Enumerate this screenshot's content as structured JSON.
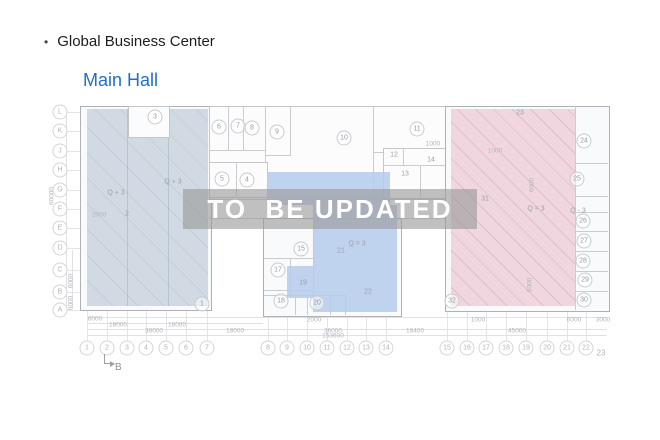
{
  "slide": {
    "bullet": "•",
    "title": "Global Business Center",
    "subtitle": "Main Hall",
    "watermark": "TO  BE UPDATED"
  },
  "colors": {
    "subtitle_blue": "#1d6ed0",
    "zone_left": "rgba(203,213,223,0.88)",
    "zone_left_hatch": "rgba(125,145,168,0.16)",
    "zone_middle": "rgba(181,203,235,0.85)",
    "zone_right": "rgba(238,211,220,0.9)",
    "zone_right_hatch": "rgba(196,144,162,0.35)",
    "watermark_band": "rgba(154,154,154,0.62)",
    "watermark_text": "#ffffff"
  },
  "plan": {
    "row_axis": [
      {
        "t": "L",
        "x": 60,
        "y": 112
      },
      {
        "t": "K",
        "x": 60,
        "y": 131
      },
      {
        "t": "J",
        "x": 60,
        "y": 151
      },
      {
        "t": "H",
        "x": 60,
        "y": 170
      },
      {
        "t": "G",
        "x": 60,
        "y": 190
      },
      {
        "t": "F",
        "x": 60,
        "y": 209
      },
      {
        "t": "E",
        "x": 60,
        "y": 228
      },
      {
        "t": "D",
        "x": 60,
        "y": 248
      },
      {
        "t": "C",
        "x": 60,
        "y": 270
      },
      {
        "t": "B",
        "x": 60,
        "y": 292
      },
      {
        "t": "A",
        "x": 60,
        "y": 310
      }
    ],
    "col_axis": [
      {
        "t": "1",
        "x": 87,
        "y": 348
      },
      {
        "t": "2",
        "x": 107,
        "y": 348
      },
      {
        "t": "3",
        "x": 127,
        "y": 348
      },
      {
        "t": "4",
        "x": 146,
        "y": 348
      },
      {
        "t": "5",
        "x": 166,
        "y": 348
      },
      {
        "t": "6",
        "x": 186,
        "y": 348
      },
      {
        "t": "7",
        "x": 207,
        "y": 348
      },
      {
        "t": "8",
        "x": 268,
        "y": 348
      },
      {
        "t": "9",
        "x": 287,
        "y": 348
      },
      {
        "t": "10",
        "x": 307,
        "y": 348
      },
      {
        "t": "11",
        "x": 327,
        "y": 348
      },
      {
        "t": "12",
        "x": 347,
        "y": 348
      },
      {
        "t": "13",
        "x": 366,
        "y": 348
      },
      {
        "t": "14",
        "x": 386,
        "y": 348
      },
      {
        "t": "15",
        "x": 447,
        "y": 348
      },
      {
        "t": "16",
        "x": 467,
        "y": 348
      },
      {
        "t": "17",
        "x": 486,
        "y": 348
      },
      {
        "t": "18",
        "x": 506,
        "y": 348
      },
      {
        "t": "19",
        "x": 526,
        "y": 348
      },
      {
        "t": "20",
        "x": 547,
        "y": 348
      },
      {
        "t": "21",
        "x": 567,
        "y": 348
      },
      {
        "t": "22",
        "x": 586,
        "y": 348
      }
    ],
    "col_axis_plain": [
      {
        "t": "23",
        "x": 601,
        "y": 353
      }
    ],
    "section_marker": {
      "t": "B"
    },
    "room_circles": [
      {
        "t": "3",
        "x": 155,
        "y": 117
      },
      {
        "t": "6",
        "x": 219,
        "y": 127
      },
      {
        "t": "7",
        "x": 238,
        "y": 126
      },
      {
        "t": "8",
        "x": 252,
        "y": 128
      },
      {
        "t": "9",
        "x": 277,
        "y": 132
      },
      {
        "t": "5",
        "x": 222,
        "y": 179
      },
      {
        "t": "4",
        "x": 247,
        "y": 180
      },
      {
        "t": "10",
        "x": 344,
        "y": 138
      },
      {
        "t": "11",
        "x": 417,
        "y": 129
      },
      {
        "t": "15",
        "x": 301,
        "y": 249
      },
      {
        "t": "17",
        "x": 278,
        "y": 270
      },
      {
        "t": "18",
        "x": 281,
        "y": 301
      },
      {
        "t": "20",
        "x": 317,
        "y": 303
      },
      {
        "t": "1",
        "x": 202,
        "y": 304
      },
      {
        "t": "24",
        "x": 584,
        "y": 141
      },
      {
        "t": "25",
        "x": 577,
        "y": 179
      },
      {
        "t": "26",
        "x": 583,
        "y": 221
      },
      {
        "t": "27",
        "x": 584,
        "y": 241
      },
      {
        "t": "28",
        "x": 583,
        "y": 261
      },
      {
        "t": "29",
        "x": 585,
        "y": 280
      },
      {
        "t": "30",
        "x": 584,
        "y": 300
      },
      {
        "t": "32",
        "x": 452,
        "y": 301
      }
    ],
    "room_texts": [
      {
        "t": "2",
        "x": 127,
        "y": 214
      },
      {
        "t": "Q + 3",
        "x": 173,
        "y": 182
      },
      {
        "t": "Q + 3",
        "x": 116,
        "y": 193
      },
      {
        "t": "Q = 3",
        "x": 357,
        "y": 244
      },
      {
        "t": "19",
        "x": 303,
        "y": 283
      },
      {
        "t": "21",
        "x": 341,
        "y": 251
      },
      {
        "t": "22",
        "x": 368,
        "y": 292
      },
      {
        "t": "12",
        "x": 394,
        "y": 155
      },
      {
        "t": "13",
        "x": 405,
        "y": 174
      },
      {
        "t": "14",
        "x": 431,
        "y": 160
      },
      {
        "t": "23",
        "x": 520,
        "y": 113
      },
      {
        "t": "31",
        "x": 485,
        "y": 199
      },
      {
        "t": "Q = 3",
        "x": 536,
        "y": 209
      },
      {
        "t": "Q - 3",
        "x": 578,
        "y": 211
      }
    ],
    "dim_texts": [
      {
        "t": "6000",
        "x": 95,
        "y": 319
      },
      {
        "t": "2000",
        "x": 314,
        "y": 320
      },
      {
        "t": "1000",
        "x": 478,
        "y": 320
      },
      {
        "t": "6000",
        "x": 574,
        "y": 320
      },
      {
        "t": "3000",
        "x": 603,
        "y": 320
      },
      {
        "t": "18000",
        "x": 118,
        "y": 325
      },
      {
        "t": "18000",
        "x": 177,
        "y": 325
      },
      {
        "t": "36000",
        "x": 154,
        "y": 331
      },
      {
        "t": "18000",
        "x": 235,
        "y": 331
      },
      {
        "t": "36000",
        "x": 333,
        "y": 331
      },
      {
        "t": "18400",
        "x": 415,
        "y": 331
      },
      {
        "t": "45000",
        "x": 517,
        "y": 331
      },
      {
        "t": "153600",
        "x": 333,
        "y": 336
      },
      {
        "t": "1000",
        "x": 433,
        "y": 144
      },
      {
        "t": "1000",
        "x": 495,
        "y": 151
      },
      {
        "t": "2000",
        "x": 99,
        "y": 215
      }
    ],
    "vdim_texts": [
      {
        "t": "60000",
        "x": 52,
        "y": 196
      },
      {
        "t": "6000",
        "x": 71,
        "y": 281
      },
      {
        "t": "6000",
        "x": 71,
        "y": 303
      },
      {
        "t": "6000",
        "x": 532,
        "y": 185
      },
      {
        "t": "6000",
        "x": 530,
        "y": 285
      }
    ]
  }
}
